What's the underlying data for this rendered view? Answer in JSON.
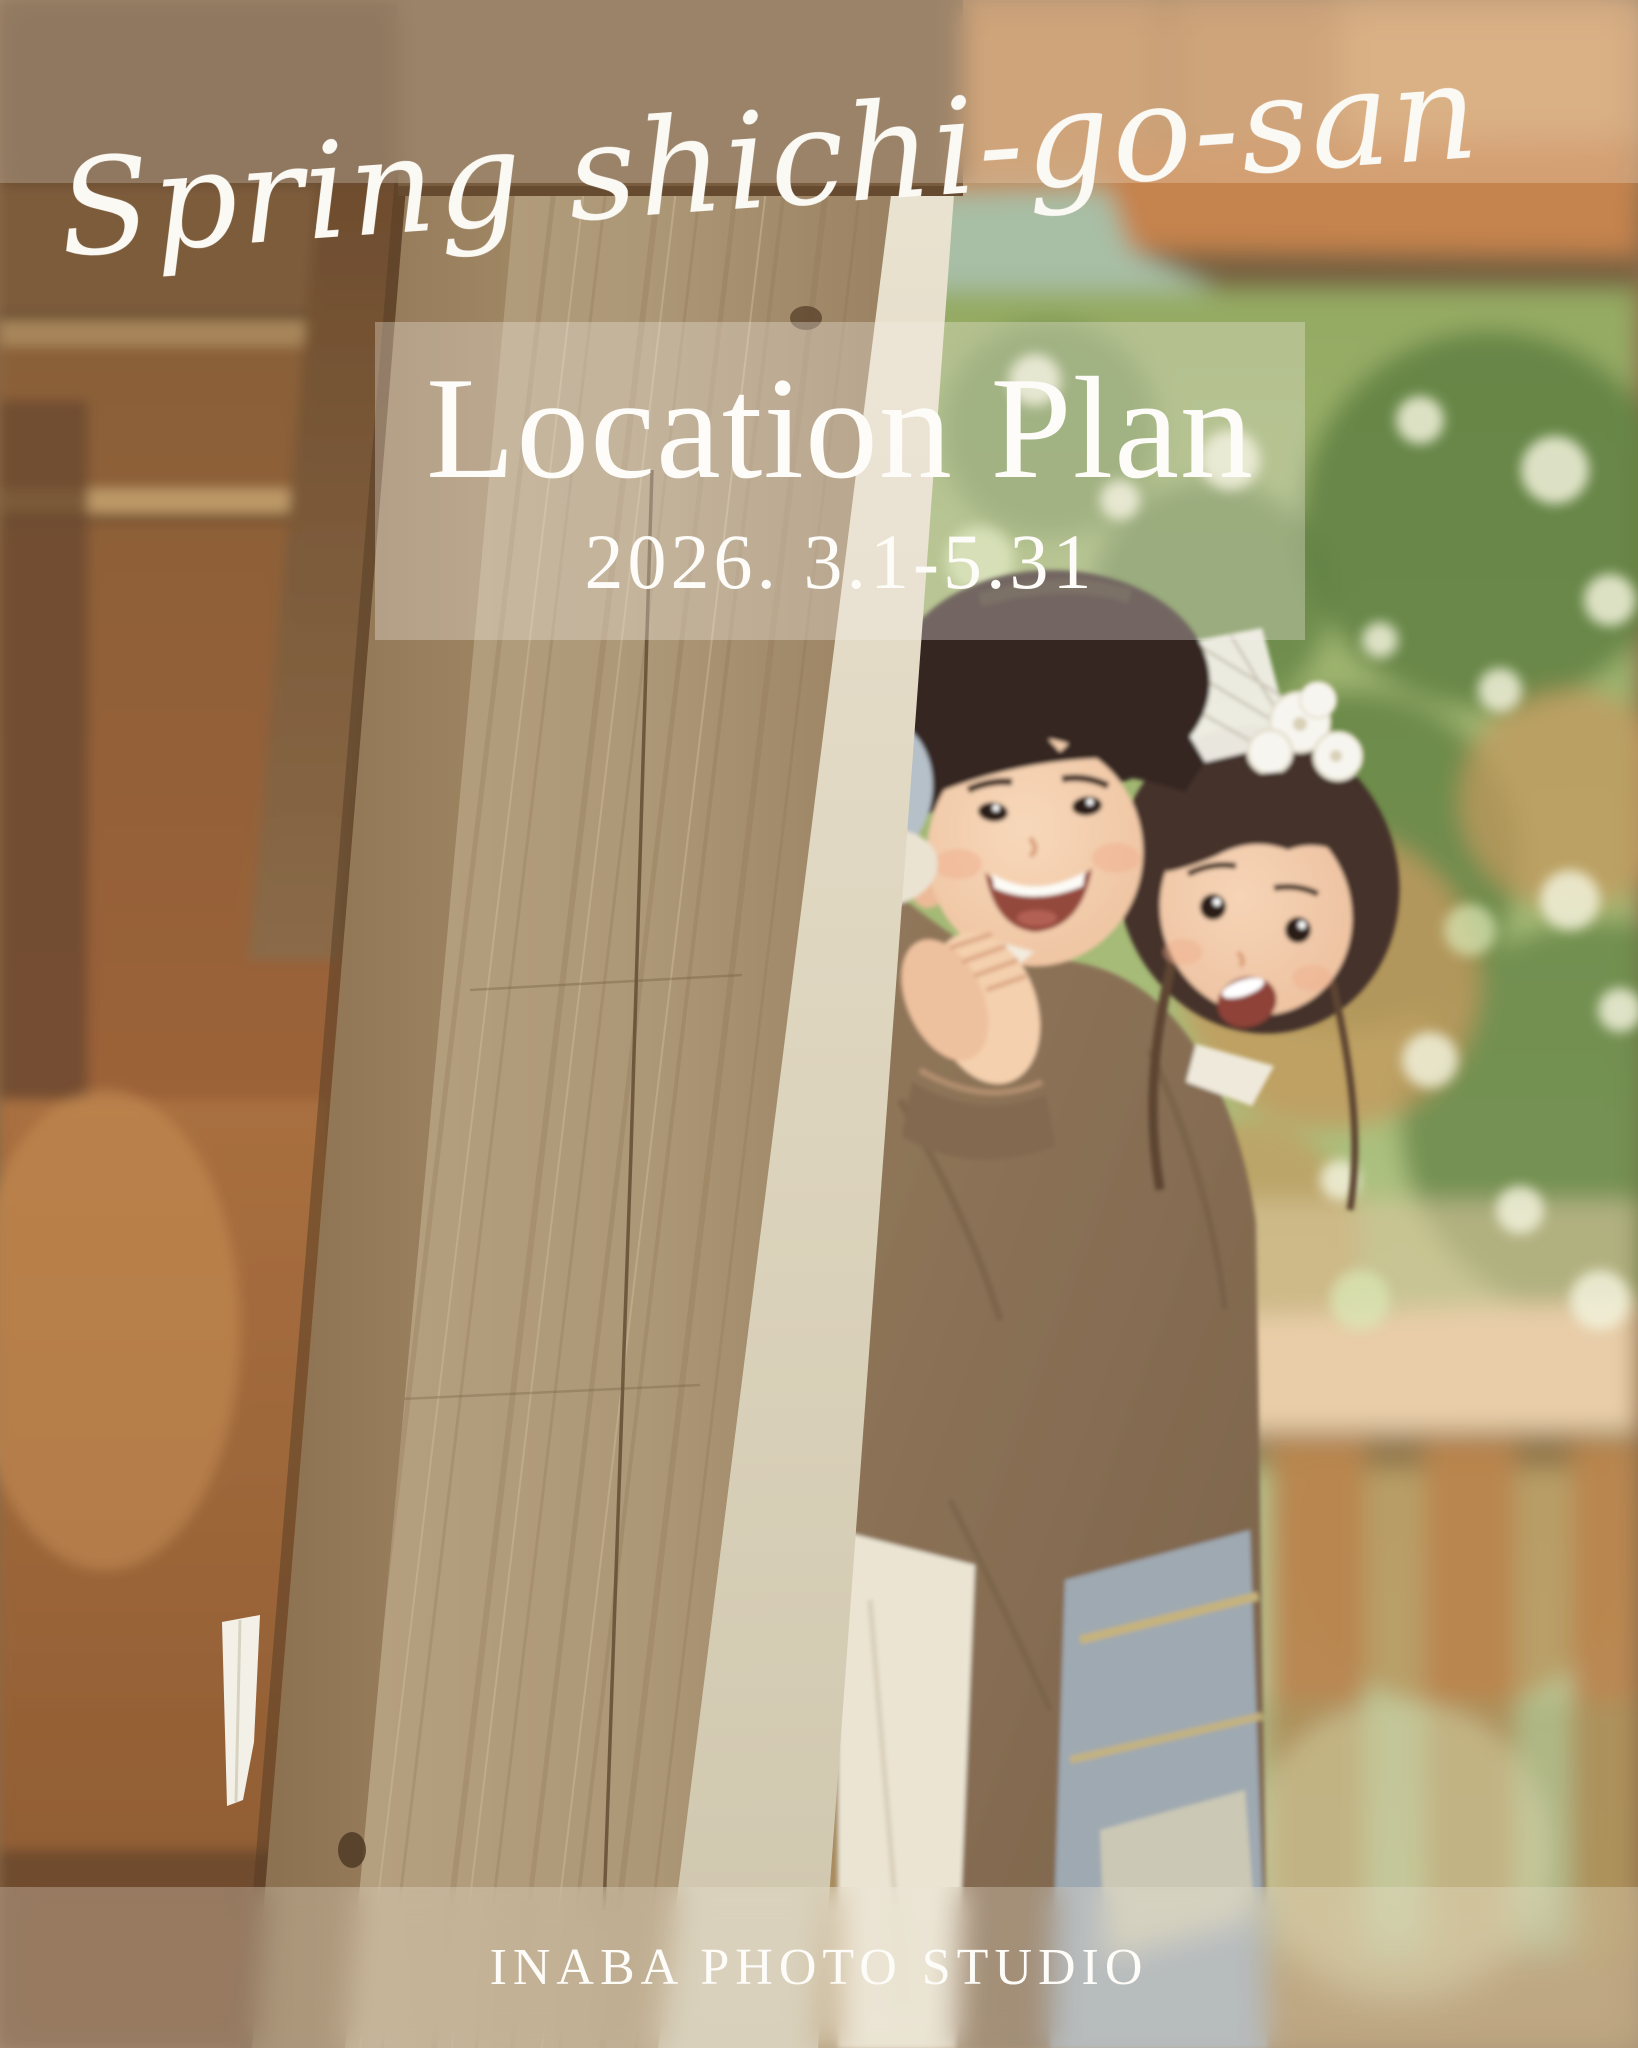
{
  "poster": {
    "script_title": "Spring shichi-go-san",
    "plan": {
      "title": "Location Plan",
      "date_range": "2026. 3.1-5.31"
    },
    "studio_name": "INABA PHOTO STUDIO"
  },
  "colors": {
    "text_white": "#fdfcf8",
    "wood_post_light": "#b09a78",
    "wood_dark_brown": "#6b4e33",
    "roof_orange": "#c5834e",
    "foliage_green": "#8fa75f",
    "kimono_taupe": "#8d7459"
  }
}
